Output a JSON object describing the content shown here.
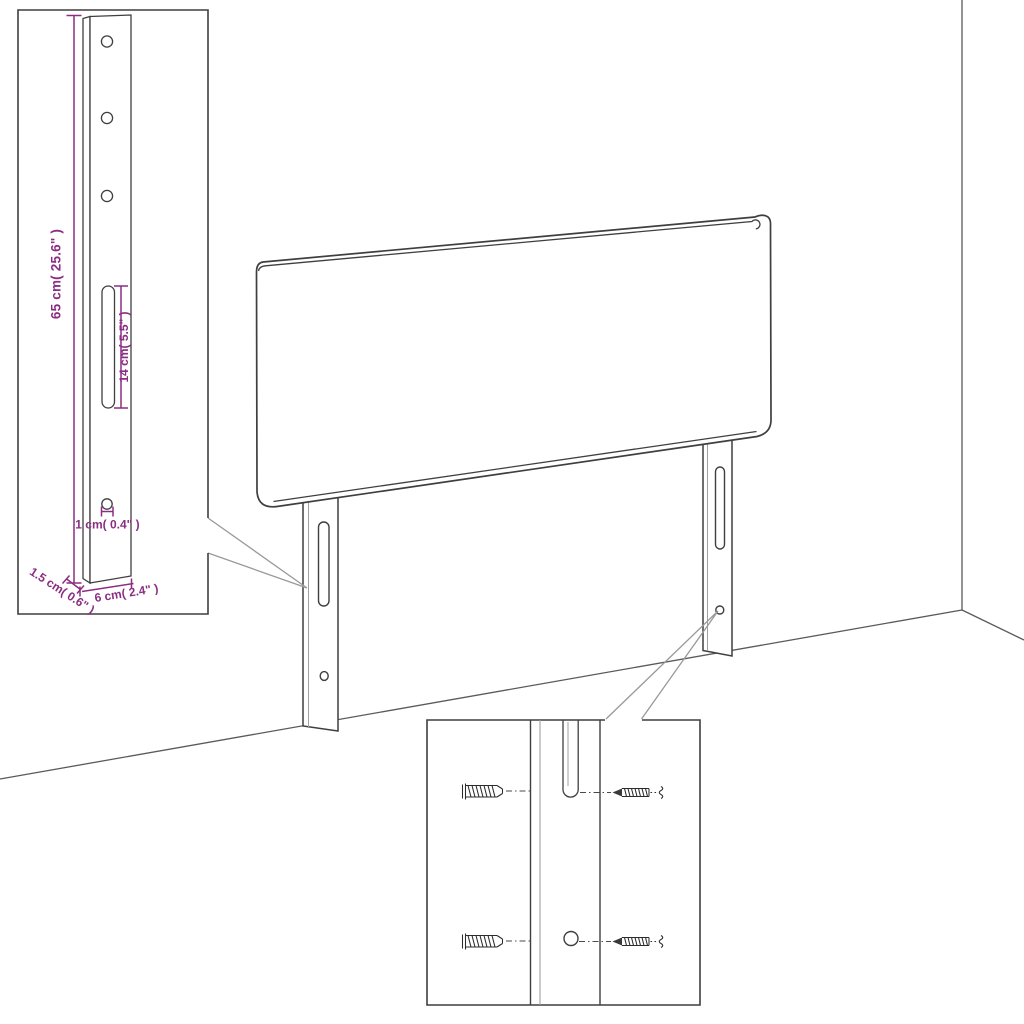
{
  "diagram_labels": {
    "height": "65 cm( 25.6\" )",
    "slot_length": "14 cm( 5.5\" )",
    "hole_diameter": "1 cm( 0.4\" )",
    "depth": "1.5 cm( 0.6\" )",
    "width": "6 cm( 2.4\" )"
  },
  "colors": {
    "background": "#ffffff",
    "outline": "#3f3f3f",
    "outline_light": "#a0a0a0",
    "wall_line": "#5a5a5a",
    "callout_line": "#999999",
    "dimension_accent": "#8B2E83",
    "hardware": "#2b2b2b"
  },
  "icons": {
    "wall_plug": "wall-plug-icon",
    "screw": "screw-icon"
  }
}
